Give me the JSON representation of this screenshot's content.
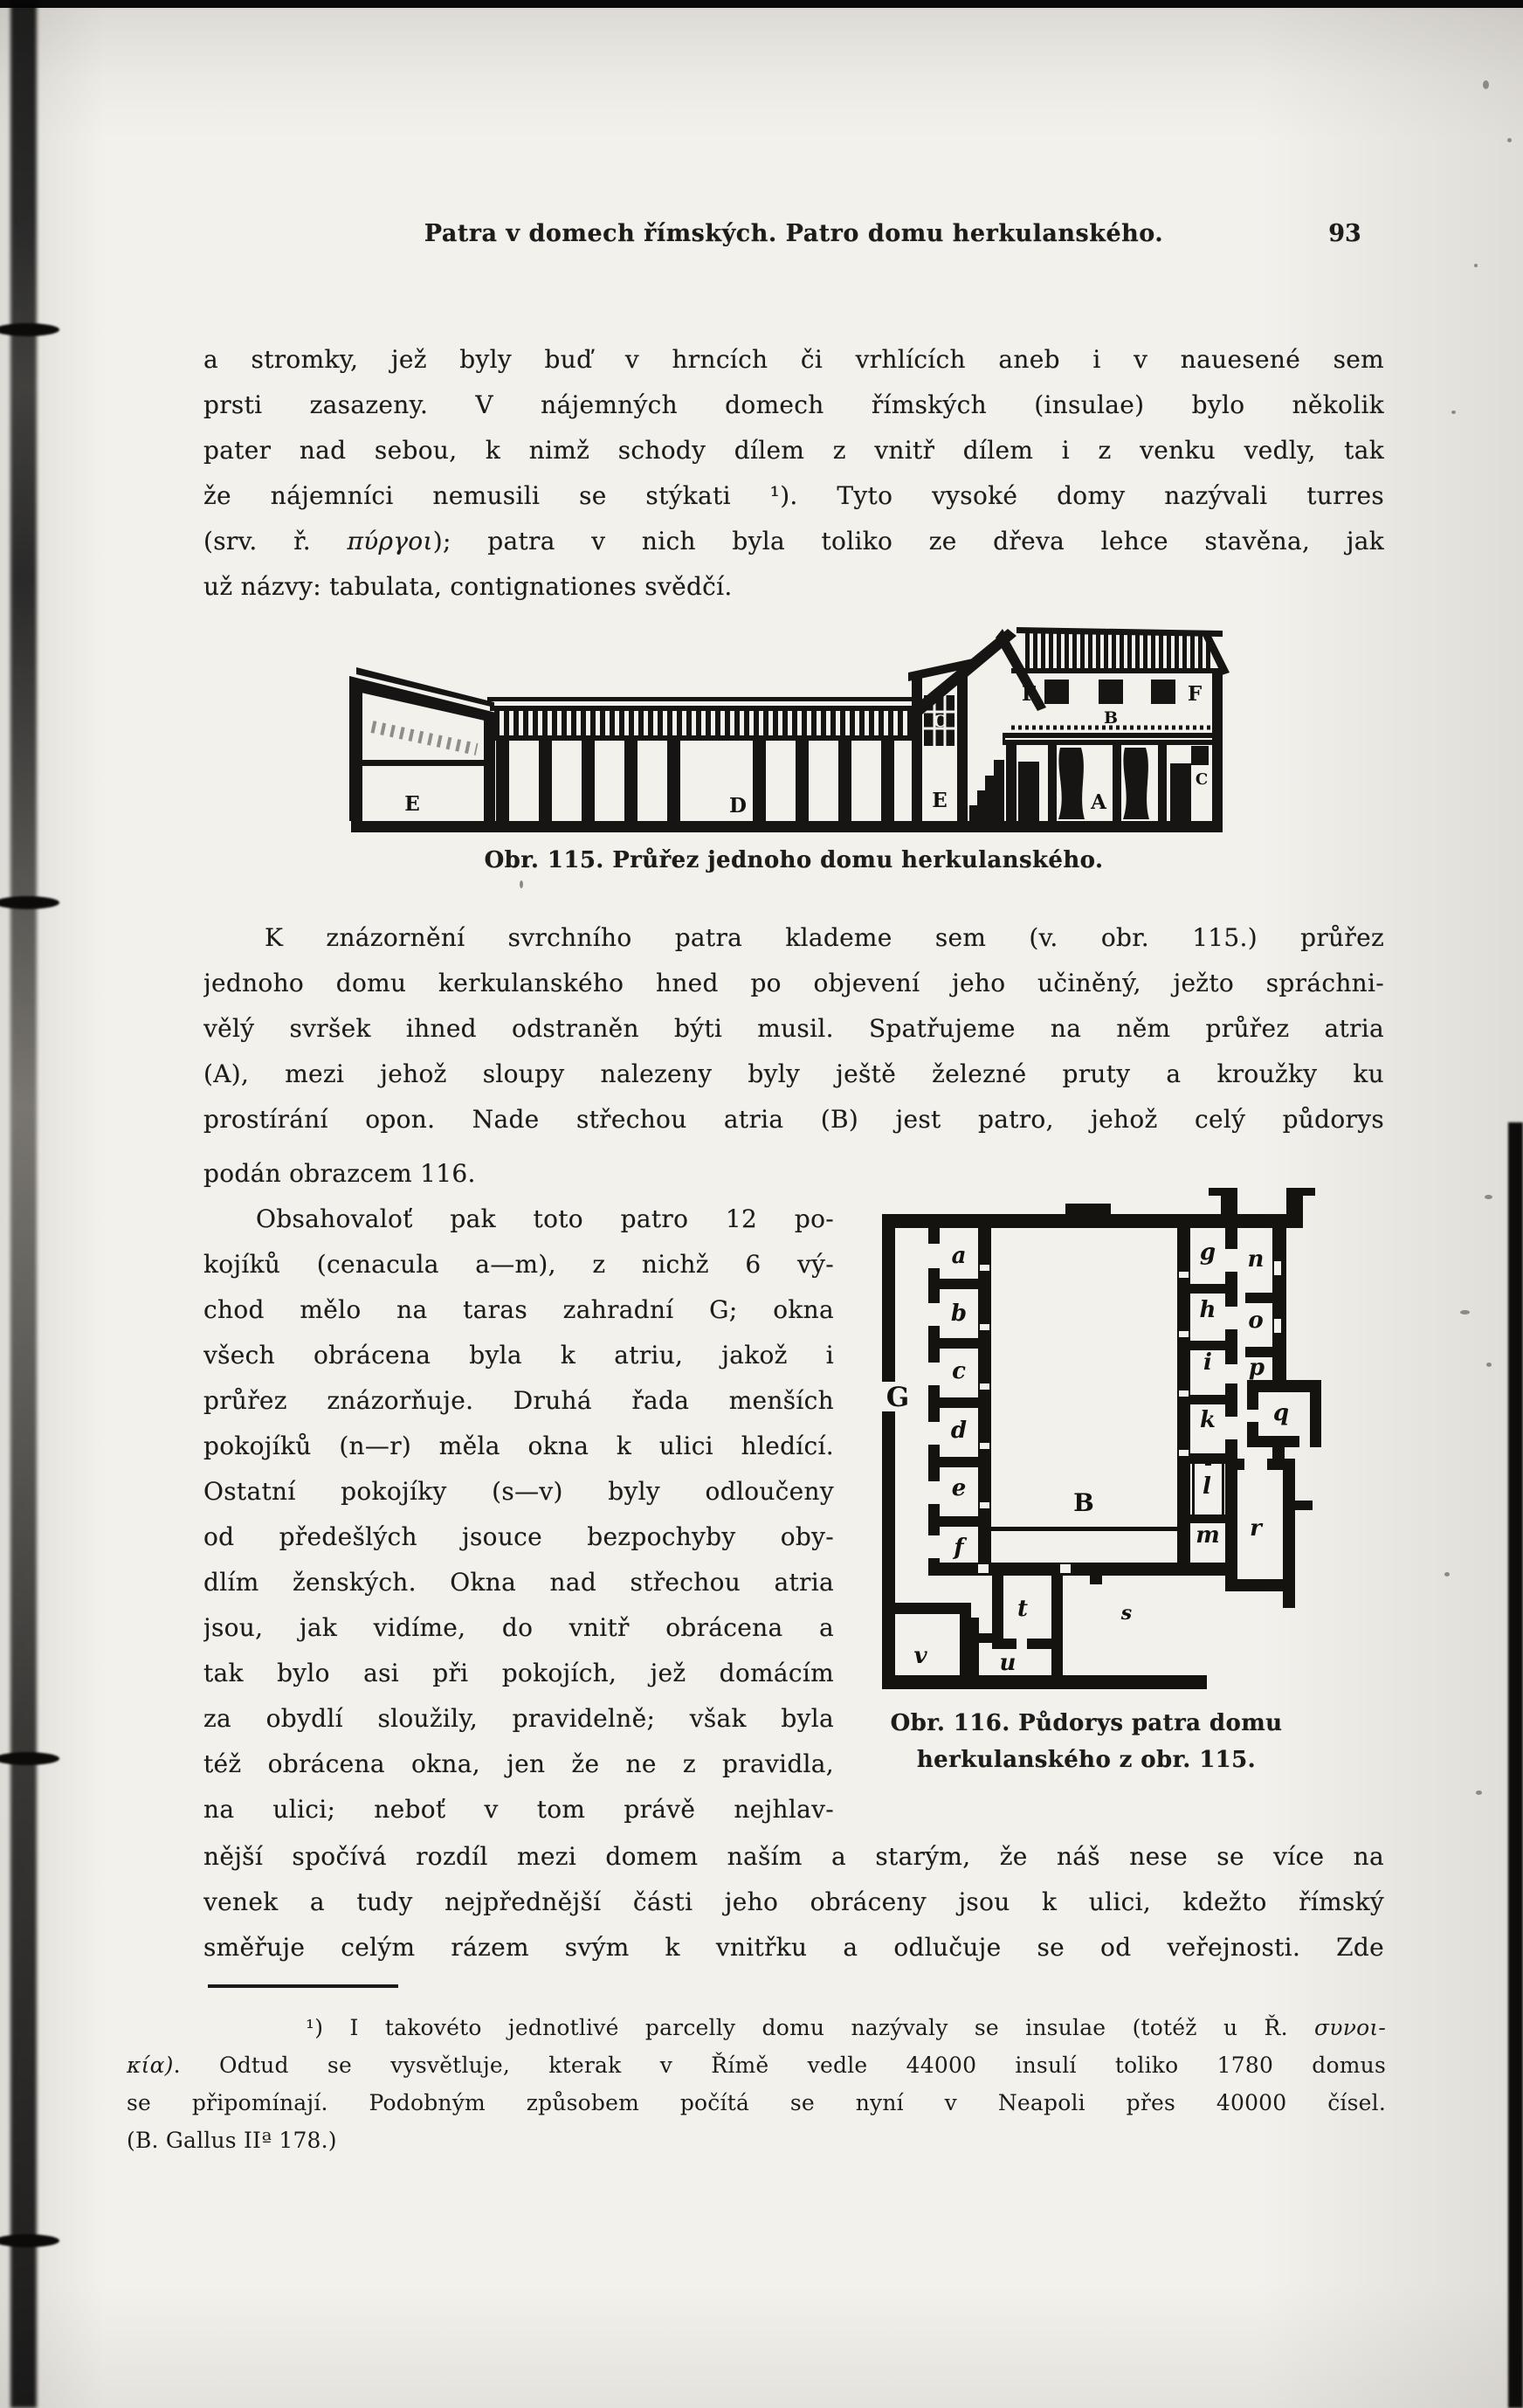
{
  "colors": {
    "paper": "#f3f1ec",
    "ink": "#1d1c1a"
  },
  "header": {
    "title": "Patra v domech římských. Patro domu herkulanského.",
    "page_number": "93"
  },
  "para1": {
    "l1": "a stromky, jež byly buď v hrncích či vrhlících aneb i v nauesené sem",
    "l2": "prsti zasazeny. V nájemných domech římských (insulae) bylo několik",
    "l3": "pater nad sebou, k nimž schody dílem z vnitř dílem i z venku vedly, tak",
    "l4": "že nájemníci nemusili se stýkati ¹). Tyto vysoké domy nazývali turres",
    "l5_pre": "(srv. ř. ",
    "l5_greek": "πύργοι",
    "l5_post": "); patra v nich byla toliko ze dřeva lehce stavěna, jak",
    "l6": "už názvy: tabulata, contignationes svědčí."
  },
  "fig115": {
    "caption": "Obr. 115. Průřez jednoho domu herkulanského.",
    "labels": {
      "shed": "E",
      "portico": "D",
      "tower_window": "C",
      "tower_base": "E",
      "upper_left": "F",
      "upper_floor": "B",
      "upper_right": "F",
      "atrium": "A",
      "right_end": "C"
    }
  },
  "para2": {
    "l1": "K znázornění svrchního patra klademe sem (v. obr. 115.) průřez",
    "l2": "jednoho domu kerkulanského hned po objevení jeho učiněný, ježto spráchni-",
    "l3": "vělý svršek ihned odstraněn býti musil. Spatřujeme na něm průřez atria",
    "l4": "(A), mezi jehož sloupy nalezeny byly ještě železné pruty a kroužky ku",
    "l5": "prostírání opon. Nade střechou atria (B) jest patro, jehož celý půdorys"
  },
  "column": {
    "c1": "podán obrazcem 116.",
    "c2": "Obsahovaloť pak toto patro 12 po-",
    "c3": "kojíků (cenacula a—m), z nichž 6 vý-",
    "c4": "chod mělo na taras zahradní G; okna",
    "c5": "všech obrácena byla k atriu, jakož i",
    "c6": "průřez znázorňuje. Druhá řada menších",
    "c7": "pokojíků (n—r) měla okna k ulici hledící.",
    "c8": "Ostatní pokojíky (s—v) byly odloučeny",
    "c9": "od předešlých jsouce bezpochyby oby-",
    "c10": "dlím ženských. Okna nad střechou atria",
    "c11": "jsou, jak vidíme, do vnitř obrácena a",
    "c12": "tak bylo asi při pokojích, jež domácím",
    "c13": "za obydlí sloužily, pravidelně; však byla",
    "c14": "též obrácena okna, jen že ne z pravidla,",
    "c15": "na ulici; neboť v tom právě nejhlav-"
  },
  "fig116": {
    "caption1": "Obr. 116. Půdorys patra domu",
    "caption2": "herkulanského z obr. 115.",
    "terrace": "G",
    "atrium": "B",
    "rooms": {
      "a": "a",
      "b": "b",
      "c": "c",
      "d": "d",
      "e": "e",
      "f": "f",
      "g": "g",
      "h": "h",
      "i": "i",
      "k": "k",
      "l": "l",
      "m": "m",
      "n": "n",
      "o": "o",
      "p": "p",
      "q": "q",
      "r": "r",
      "s": "s",
      "t": "t",
      "u": "u",
      "v": "v"
    }
  },
  "para3": {
    "l1": "nější spočívá rozdíl mezi domem naším a starým, že náš nese se více na",
    "l2": "venek a tudy nejpřednější části jeho obráceny jsou k ulici, kdežto římský",
    "l3": "směřuje celým rázem svým k vnitřku a odlučuje se od veřejnosti.  Zde"
  },
  "footnote": {
    "f1_pre": "¹) I takovéto jednotlivé parcelly domu nazývaly se insulae (totéž u Ř. ",
    "f1_greek": "συνοι-",
    "f2_greek": "κία)",
    "f2_post": ". Odtud se vysvětluje, kterak v Římě vedle 44000 insulí toliko 1780 domus",
    "f3": "se připomínají. Podobným způsobem počítá se nyní v Neapoli přes 40000 čísel.",
    "f4": "(B. Gallus IIª 178.)"
  }
}
